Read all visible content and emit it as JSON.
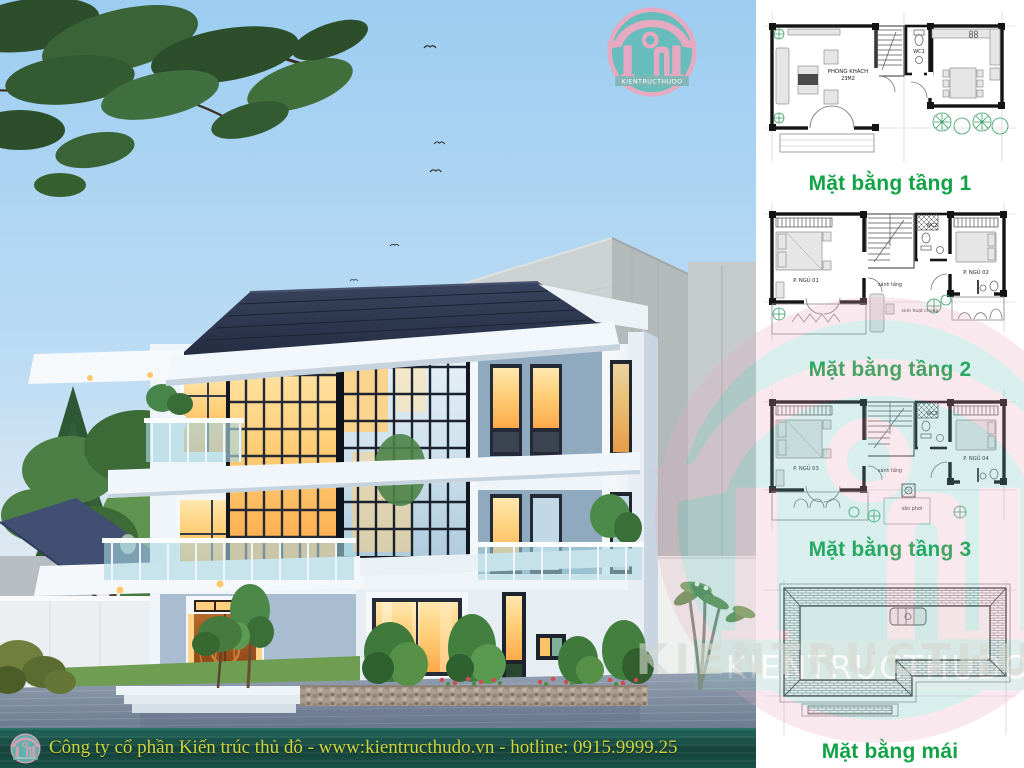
{
  "brand": {
    "logo_text": "KIENTRUCTHUDO"
  },
  "watermark": {
    "text": "KIENTRUCTHUDO"
  },
  "footer": {
    "company_line": "Công ty cổ phần Kiến trúc thủ đô - www:kientructhudo.vn - hotline: 0915.9999.25",
    "bg_color": "#1b5348",
    "text_color": "#cdd53f"
  },
  "colors": {
    "caption_green": "#12a347",
    "sky_blue": "#9ccdf1",
    "roof_navy": "#2b3550",
    "logo_teal": "#63bdb9",
    "logo_pink": "#e9a8bf"
  },
  "plans": [
    {
      "caption": "Mặt bằng tầng 1",
      "labels": {
        "living": "PHÒNG KHÁCH",
        "living_area": "23M2",
        "wc": "WC1"
      }
    },
    {
      "caption": "Mặt bằng tầng 2",
      "labels": {
        "bedroom1": "P. NGỦ 01",
        "wc": "WC2",
        "hall": "sảnh tầng",
        "bedroom2": "P. NGỦ 02",
        "common": "sinh hoạt chung"
      }
    },
    {
      "caption": "Mặt bằng tầng 3",
      "labels": {
        "bedroom1": "P. NGỦ 03",
        "wc": "WC3",
        "hall": "sảnh tầng",
        "bedroom2": "P. NGỦ 04",
        "yard": "sân phơi"
      }
    },
    {
      "caption": "Mặt bằng mái",
      "labels": {}
    }
  ]
}
